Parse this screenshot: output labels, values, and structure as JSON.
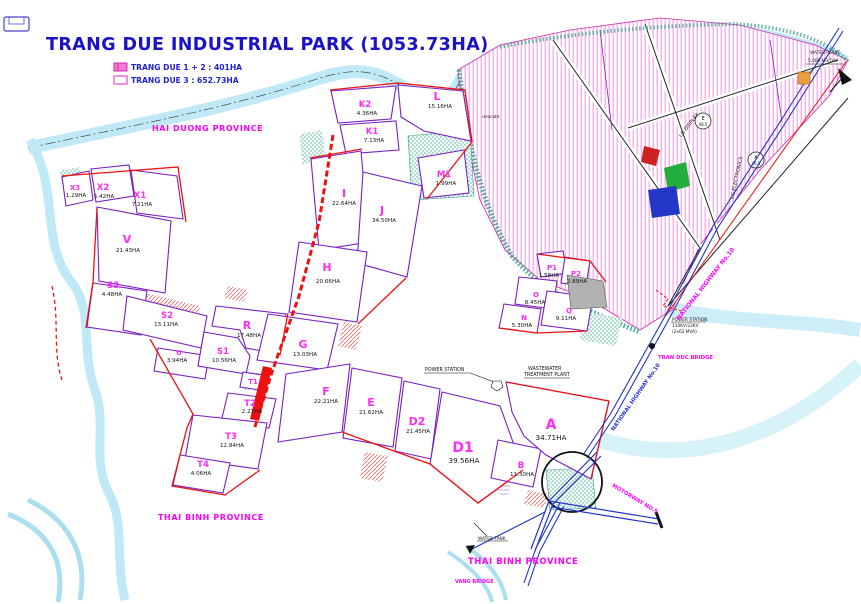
{
  "title": "TRANG DUE INDUSTRIAL PARK (1053.73HA)",
  "legend": {
    "item1": "TRANG DUE 1 + 2 : 401HA",
    "item2": "TRANG DUE 3 : 652.73HA"
  },
  "provinces": {
    "hai_duong": "HAI DUONG PROVINCE",
    "thai_binh_1": "THAI BINH PROVINCE",
    "thai_binh_2": "THAI BINH PROVINCE"
  },
  "zones": {
    "K2": {
      "id": "K2",
      "area": "4.36HA"
    },
    "K1": {
      "id": "K1",
      "area": "7.13HA"
    },
    "L": {
      "id": "L",
      "area": "15.16HA"
    },
    "M1": {
      "id": "M1",
      "area": "1.99HA"
    },
    "I": {
      "id": "I",
      "area": "22.64HA"
    },
    "J": {
      "id": "J",
      "area": "34.50HA"
    },
    "H": {
      "id": "H",
      "area": "20.66HA"
    },
    "G": {
      "id": "G",
      "area": "13.03HA"
    },
    "R": {
      "id": "R",
      "area": "17.48HA"
    },
    "F": {
      "id": "F",
      "area": "22.21HA"
    },
    "E": {
      "id": "E",
      "area": "21.62HA"
    },
    "D2": {
      "id": "D2",
      "area": "21.45HA"
    },
    "D1": {
      "id": "D1",
      "area": "39.56HA"
    },
    "A": {
      "id": "A",
      "area": "34.71HA"
    },
    "B": {
      "id": "B",
      "area": "11.30HA"
    },
    "V": {
      "id": "V",
      "area": "21.43HA"
    },
    "X1": {
      "id": "X1",
      "area": "7.21HA"
    },
    "X2": {
      "id": "X2",
      "area": "5.42HA"
    },
    "X3": {
      "id": "X3",
      "area": "1.29HA"
    },
    "S3": {
      "id": "S3",
      "area": "4.48HA"
    },
    "S2": {
      "id": "S2",
      "area": "13.11HA"
    },
    "S1": {
      "id": "S1",
      "area": "10.56HA"
    },
    "U": {
      "id": "U",
      "area": "3.94HA"
    },
    "T1": {
      "id": "T1"
    },
    "T2": {
      "id": "T2",
      "area": "2.21HA"
    },
    "T3": {
      "id": "T3",
      "area": "12.84HA"
    },
    "T4": {
      "id": "T4",
      "area": "4.06HA"
    },
    "P1": {
      "id": "P1",
      "area": "1.58HA"
    },
    "P2": {
      "id": "P2",
      "area": "2.89HA"
    },
    "O": {
      "id": "O",
      "area": "8.45HA"
    },
    "N": {
      "id": "N",
      "area": "5.30HA"
    },
    "Q": {
      "id": "Q",
      "area": "9.11HA"
    }
  },
  "roads": {
    "nh10_upper": "NATIONAL HIGHWAY No.10",
    "nh10_lower": "NATIONAL HIGHWAY No.10",
    "motorway": "MOTORWAY NO.5",
    "tran_duc_bridge": "TRAN DUC BRIDGE",
    "vang_bridge": "VANG BRIDGE"
  },
  "facilities": {
    "power_station": "POWER STATION",
    "wastewater_line1": "WASTEWATER",
    "wastewater_line2": "TREATMENT PLANT",
    "substation_line1": "POWER STATION",
    "substation_line2": "110KV/22KV",
    "substation_line3": "(2x63 MVA)",
    "water_tank": "WATER TANK",
    "water_plant_line1": "WATER PLANT",
    "water_plant_line2": "5.000 M3/DAY",
    "note": "relocate"
  },
  "tenants": {
    "lg_display": "LG DISPLAY",
    "lg_electronics": "LG ELECTRONICS"
  },
  "markers": {
    "circle_e_letter": "E",
    "circle_e_value": "48.5",
    "circle_a_letter": "A",
    "circle_a_value": "46.5"
  },
  "colors": {
    "title_blue": "#1a12c4",
    "label_magenta": "#ff00ff",
    "boundary_red": "#ee1111",
    "parcel_purple": "#7a1fc0",
    "river_cyan": "#bfe9f6",
    "hatch_pink": "#f9a8e8",
    "green_band": "#2f9e86",
    "road_blue": "#2233cc"
  }
}
